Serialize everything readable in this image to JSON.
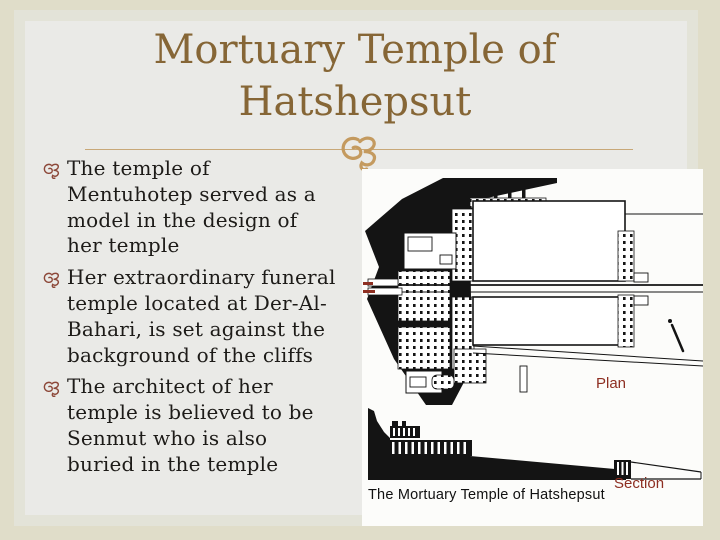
{
  "colors": {
    "page-bg": "#e0ddc9",
    "slide-bg": "#eaeae7",
    "slide-edge": "#e3e3d8",
    "title-brown": "#866636",
    "divider-line": "#c8a878",
    "ornament-gold": "#c49a5f",
    "bullet-maroon": "#8d4839",
    "body-text": "#1d1b18",
    "figure-bg": "#fcfcfa",
    "drawing-ink": "#141414",
    "label-red": "#8e2f22"
  },
  "slide": {
    "title": "Mortuary Temple of\nHatshepsut",
    "bullets": [
      {
        "text": "The temple of\nMentuhotep served as a\nmodel in the design of\nher temple"
      },
      {
        "text": "Her extraordinary funeral\ntemple located at Der-Al-\nBahari, is set against the\nbackground of the cliffs"
      },
      {
        "text": "The architect of her\ntemple is believed to be\nSenmut who is also\nburied in the temple"
      }
    ]
  },
  "figure": {
    "plan_label": "Plan",
    "section_label": "Section",
    "caption": "The Mortuary Temple of Hatshepsut"
  }
}
